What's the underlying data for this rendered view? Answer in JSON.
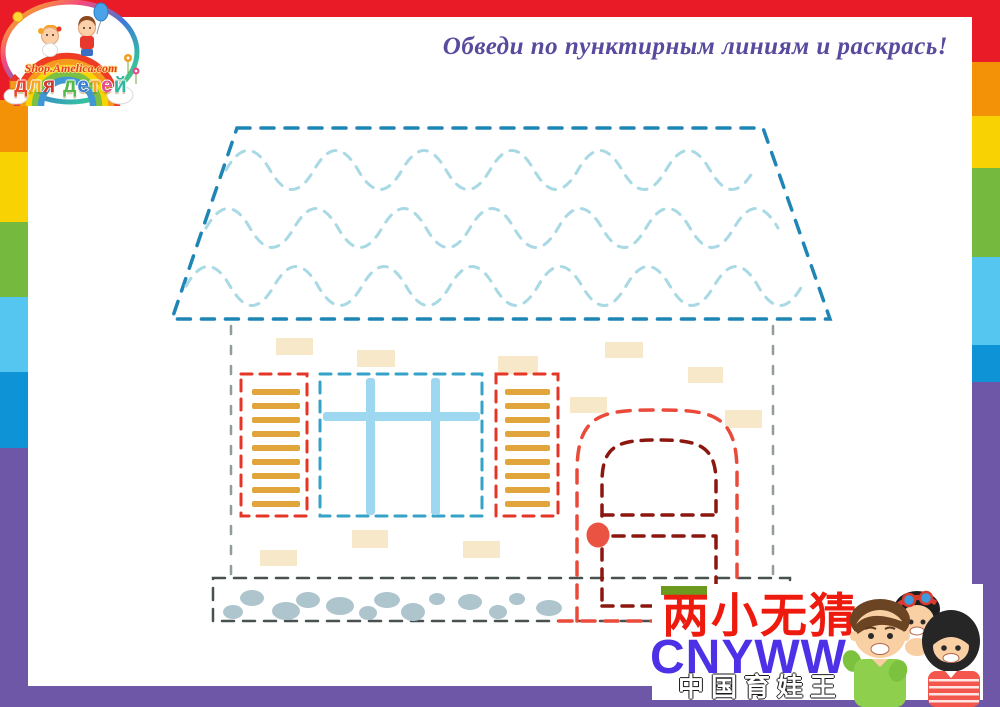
{
  "header": {
    "instruction": "Обведи по пунктирным линиям и раскрась!"
  },
  "logo": {
    "site": "Shop.Amelica.com",
    "tagline": "для детей",
    "tagline_letter_colors": [
      "#e8452c",
      "#f5a623",
      "#d2372e",
      "#ffffff",
      "#53b948",
      "#3a7fd5",
      "#f5a623",
      "#e84c8b",
      "#2eb5a0"
    ]
  },
  "watermark": {
    "line1": "两小无猜",
    "line2": "CNYWW",
    "line3": "中国育娃王"
  },
  "colors": {
    "frame_red": "#e81b26",
    "frame_orange": "#f39207",
    "frame_yellow": "#f8d203",
    "frame_green": "#76b93f",
    "frame_lightblue": "#55c6f0",
    "frame_blue": "#0e94d6",
    "frame_purple": "#6d57a6",
    "heading_text": "#5a4a9e",
    "roof_outline": "#1f85b5",
    "roof_waves": "#a8d9e4",
    "window_dash": "#35a2c8",
    "window_frame": "#9ed7f0",
    "shutter_dash": "#e53526",
    "shutter_slats": "#e2a53c",
    "door_outer_dash": "#ea4a3a",
    "door_inner_dash": "#8c170e",
    "door_knob": "#ea5242",
    "wall_dash": "#939c9d",
    "foundation_dash": "#47514f",
    "pebbles": "#aec5cd",
    "bricks": "#f6e8c8",
    "watermark_red": "#ed1a0d",
    "watermark_blue": "#4c31e6",
    "watermark_green_bar": "#6b9a1e"
  }
}
